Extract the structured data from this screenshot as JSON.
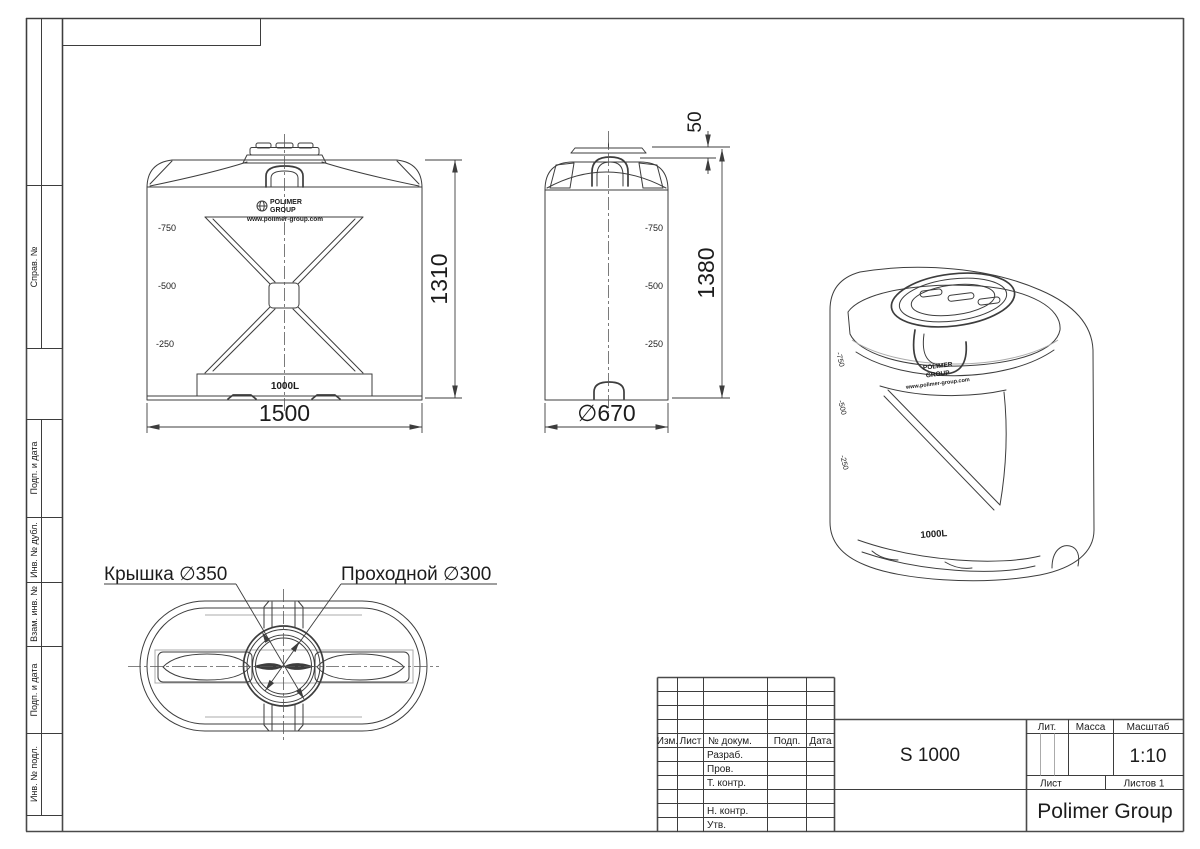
{
  "left_strip": {
    "labels": [
      "Справ. №",
      "Подп. и дата",
      "Инв. № дубл.",
      "Взам. инв. №",
      "Подп. и дата",
      "Инв. № подл."
    ]
  },
  "brand": {
    "name_line1": "POLIMER",
    "name_line2": "GROUP",
    "url": "www.polimer-group.com"
  },
  "front_view": {
    "levels": [
      "-750",
      "-500",
      "-250"
    ],
    "volume": "1000L",
    "dim_width": "1500",
    "dim_height": "1310"
  },
  "side_view": {
    "levels": [
      "-750",
      "-500",
      "-250"
    ],
    "dim_lid_height": "50",
    "dim_height": "1380",
    "dim_diameter": "∅670"
  },
  "iso_view": {
    "levels": [
      "-750",
      "-500",
      "-250"
    ],
    "volume": "1000L"
  },
  "top_view": {
    "lid_label": "Крышка ∅350",
    "pass_label": "Проходной ∅300"
  },
  "title_block": {
    "col_izm": "Изм.",
    "col_list": "Лист",
    "col_doc": "№ докум.",
    "col_sign": "Подп.",
    "col_date": "Дата",
    "row_razrab": "Разраб.",
    "row_prov": "Пров.",
    "row_tkontr": "Т. контр.",
    "row_nkontr": "Н. контр.",
    "row_utv": "Утв.",
    "designation": "S 1000",
    "lit_label": "Лит.",
    "mass_label": "Масса",
    "scale_label": "Масштаб",
    "scale_value": "1:10",
    "sheet_label": "Лист",
    "sheets_label": "Листов 1",
    "company": "Polimer Group"
  }
}
